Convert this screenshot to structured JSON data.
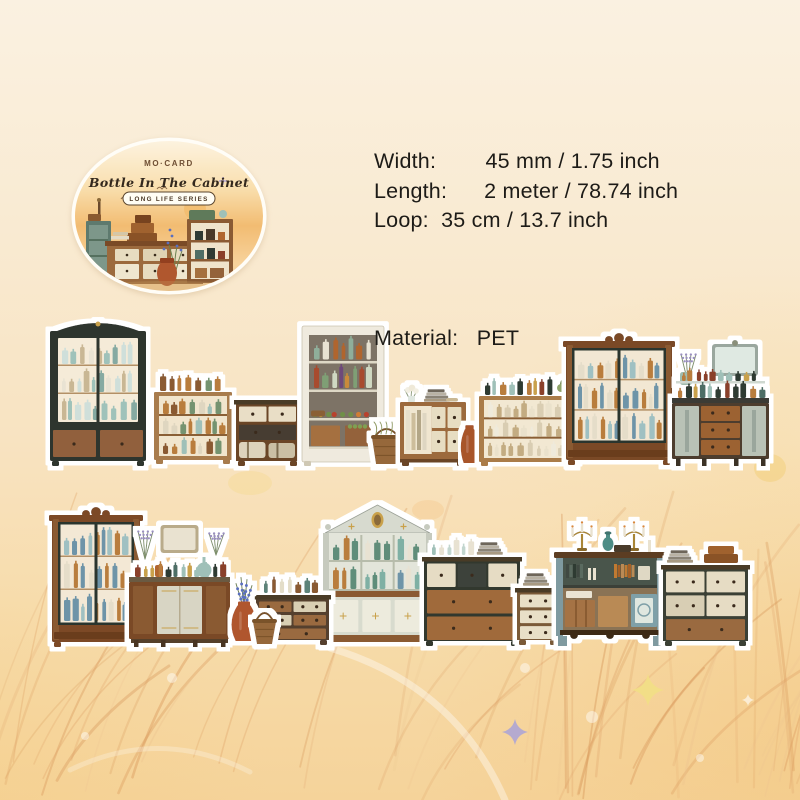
{
  "badge": {
    "brand": "MO·CARD",
    "title": "Bottle In The Cabinet",
    "series": "LONG LIFE SERIES"
  },
  "specs": {
    "width_label": "Width:",
    "width_value": "45 mm / 1.75 inch",
    "length_label": "Length:",
    "length_value": "2 meter / 78.74 inch",
    "loop_label": "Loop:",
    "loop_value": "35 cm / 13.7 inch",
    "material_label": "Material:",
    "material_value": "PET",
    "display_block": "Width:        45 mm / 1.75 inch\nLength:      2 meter / 78.74 inch\nLoop:  35 cm / 13.7 inch",
    "material_line": "Material:   PET"
  },
  "colors": {
    "background_top": "#faf1e1",
    "background_bottom": "#f5d39a",
    "text": "#1d1b17",
    "halo": "#ffffff",
    "dark_cabinet": "#2e342f",
    "wood": "#9c6a3d",
    "walnut": "#7a4a28",
    "cream_drawer": "#e6dcc4",
    "terracotta": "#b0572e",
    "teal": "#7f9aa0",
    "badge_sky": "#f2bc72"
  },
  "palettes": {
    "glass": [
      "#c2d6cf",
      "#9fc0b8",
      "#e8e2d2"
    ],
    "jars": [
      "#5d8379",
      "#b6cdc6",
      "#8a5a33",
      "#e3ddc8"
    ],
    "liqueur": [
      "#b97d3c",
      "#4e6e66",
      "#2f3a33",
      "#9fc0b8",
      "#8a3f2a",
      "#c9a14c"
    ],
    "cabinetBottles": [
      "#cfdfda",
      "#9fc2ba",
      "#e9e3d3",
      "#86aaa2",
      "#c9b794"
    ],
    "amberGreen": [
      "#b97d3c",
      "#74936f",
      "#9fc0b8",
      "#8a5a33",
      "#dfd6c0"
    ],
    "whites": [
      "#eae1cb",
      "#d9cdb2",
      "#c3ac82",
      "#efeadb"
    ],
    "armoireBottles": [
      "#9fc0c2",
      "#b97d3c",
      "#e5ddc9",
      "#6e94a8"
    ],
    "pantryJars": [
      "#d9cfb8",
      "#e8e2d2",
      "#b0652f",
      "#8fae9a"
    ],
    "pantryColor": [
      "#a84b2f",
      "#7f9f74",
      "#c98a3b",
      "#cfd8c2",
      "#6e4a7a"
    ],
    "produce": [
      "#b8432f",
      "#cf7e35",
      "#6f8f4a",
      "#d9b13e"
    ],
    "hutchBottles": [
      "#5f8d7a",
      "#7fb0a4",
      "#b97d3c",
      "#e8e2d2",
      "#6e94a8"
    ]
  },
  "scene": {
    "strip1": {
      "items": [
        {
          "name": "dark-display-cabinet",
          "kind": "glass-cabinet",
          "x": 50,
          "y": 319,
          "w": 96,
          "h": 147,
          "frame": "#2e342f",
          "interior": "#f5ebd8",
          "rows": 3,
          "pal": "cabinetBottles",
          "pediment": "arch",
          "base": "drawers",
          "baseColors": [
            "#91613c",
            "#91613c"
          ],
          "seed": 11
        },
        {
          "name": "bottle-shelf-unit",
          "kind": "open-shelf",
          "x": 154,
          "y": 374,
          "w": 78,
          "h": 90,
          "frame": "#a87c4e",
          "interior": "#f1e5cd",
          "rows": 3,
          "pal": "amberGreen",
          "seed": 23
        },
        {
          "name": "suitcase-chest",
          "kind": "chest",
          "x": 236,
          "y": 400,
          "w": 63,
          "h": 66,
          "frame": "#6b4527",
          "rowsSpec": [
            [
              "#e9dec6",
              "#e9dec6"
            ],
            [
              "#473d33"
            ]
          ],
          "bottom": "suitcases",
          "seed": 5
        },
        {
          "name": "pantry-shelf",
          "kind": "pantry",
          "x": 302,
          "y": 326,
          "w": 82,
          "h": 140
        },
        {
          "name": "harvest-basket",
          "kind": "basket",
          "x": 371,
          "y": 430,
          "w": 31,
          "h": 34,
          "greens": true
        },
        {
          "name": "book-cabinet",
          "kind": "small-cabinet",
          "x": 400,
          "y": 386,
          "w": 66,
          "h": 80
        },
        {
          "name": "clay-jug",
          "kind": "vase",
          "x": 459,
          "y": 419,
          "w": 21,
          "h": 46,
          "color": "#a8542c",
          "flowers": false
        },
        {
          "name": "jar-linen-shelf",
          "kind": "open-shelf",
          "x": 479,
          "y": 378,
          "w": 99,
          "h": 88,
          "frame": "#aa7c4a",
          "interior": "#f2e8d2",
          "rows": 3,
          "pal": "whites",
          "topPal": "liqueur",
          "plant": true,
          "seed": 31
        },
        {
          "name": "walnut-armoire",
          "kind": "glass-cabinet",
          "x": 566,
          "y": 333,
          "w": 106,
          "h": 132,
          "frame": "#7a4a28",
          "doors": "#2b342e",
          "columns": true,
          "interior": "#f2e7d3",
          "rows": 3,
          "pal": "armoireBottles",
          "pediment": "crown",
          "base": "plinth",
          "seed": 41
        },
        {
          "name": "mirror-bottle-dresser",
          "kind": "mirror-dresser",
          "x": 672,
          "y": 344,
          "w": 97,
          "h": 122,
          "variant": 1,
          "seed": 71
        }
      ]
    },
    "strip2": {
      "items": [
        {
          "name": "dark-armoire",
          "kind": "glass-cabinet",
          "x": 52,
          "y": 507,
          "w": 88,
          "h": 140,
          "frame": "#7c4a28",
          "doors": "#2c352f",
          "columns": true,
          "interior": "#f3e8d5",
          "rows": 3,
          "pal": "armoireBottles",
          "pediment": "crown",
          "base": "plinth",
          "seed": 7
        },
        {
          "name": "vanity-dresser",
          "kind": "mirror-dresser",
          "x": 129,
          "y": 523,
          "w": 101,
          "h": 124,
          "variant": 2,
          "seed": 79
        },
        {
          "name": "pediment-hutch",
          "kind": "hutch",
          "x": 321,
          "y": 503,
          "w": 113,
          "h": 143
        },
        {
          "name": "jar-chest",
          "kind": "chest",
          "x": 256,
          "y": 577,
          "w": 73,
          "h": 68,
          "frame": "#54412f",
          "rowsSpec": [
            [
              "#9a6a3f",
              "#d9cfb4"
            ],
            [
              "#d9cfb4",
              "#9a6a3f"
            ],
            [
              "#9a6a3f"
            ]
          ],
          "top": "jars",
          "seed": 13
        },
        {
          "name": "terracotta-flower-vase",
          "kind": "vase",
          "x": 229,
          "y": 565,
          "w": 30,
          "h": 78,
          "color": "#b0572e",
          "flowers": true,
          "flowerColor": "#5a6fc0"
        },
        {
          "name": "wicker-basket",
          "kind": "basket",
          "x": 252,
          "y": 614,
          "w": 25,
          "h": 30,
          "greens": false
        },
        {
          "name": "linen-chest",
          "kind": "chest",
          "x": 424,
          "y": 539,
          "w": 96,
          "h": 107,
          "frame": "#32382f",
          "rowsSpec": [
            [
              "#e6dcc4",
              "#3c433a",
              "#e6dcc4"
            ],
            [
              "#a06a3a"
            ],
            [
              "#a06a3a"
            ]
          ],
          "top": "bottles",
          "seed": 17
        },
        {
          "name": "book-drawer-unit",
          "kind": "chest",
          "x": 517,
          "y": 570,
          "w": 42,
          "h": 75,
          "frame": "#7a5a38",
          "rowsSpec": [
            [
              "#e8dfc7"
            ],
            [
              "#e8dfc7"
            ],
            [
              "#e8dfc7"
            ]
          ],
          "top": "books",
          "seed": 19
        },
        {
          "name": "candelabra-sideboard",
          "kind": "sideboard",
          "x": 556,
          "y": 518,
          "w": 108,
          "h": 128
        },
        {
          "name": "box-chest",
          "kind": "chest",
          "x": 663,
          "y": 547,
          "w": 85,
          "h": 99,
          "frame": "#3a3f36",
          "rowsSpec": [
            [
              "#e6dcc4",
              "#e6dcc4"
            ],
            [
              "#d8ceb4",
              "#e6dcc4"
            ],
            [
              "#9a6a3f"
            ]
          ],
          "top": "boxes",
          "seed": 29
        }
      ]
    }
  },
  "decor": {
    "sparkles": [
      {
        "x": 515,
        "y": 732,
        "r": 13,
        "color": "#a9a2d8",
        "opacity": 0.85
      },
      {
        "x": 648,
        "y": 690,
        "r": 16,
        "color": "#f2df85",
        "opacity": 0.9
      },
      {
        "x": 748,
        "y": 700,
        "r": 6,
        "color": "#ffffff",
        "opacity": 0.6
      }
    ],
    "dots": [
      {
        "x": 525,
        "y": 668,
        "r": 5
      },
      {
        "x": 592,
        "y": 717,
        "r": 6
      },
      {
        "x": 172,
        "y": 678,
        "r": 5
      },
      {
        "x": 85,
        "y": 736,
        "r": 4
      },
      {
        "x": 700,
        "y": 758,
        "r": 4
      }
    ],
    "blobs": [
      {
        "x": 770,
        "y": 468,
        "rx": 16,
        "ry": 14,
        "color": "#f2cf7e",
        "opacity": 0.55
      },
      {
        "x": 250,
        "y": 483,
        "rx": 22,
        "ry": 12,
        "color": "#f4d98e",
        "opacity": 0.4
      },
      {
        "x": 428,
        "y": 510,
        "rx": 16,
        "ry": 10,
        "color": "#f6c98c",
        "opacity": 0.4
      }
    ],
    "wheat_colors": [
      "#e2a96f",
      "#ecc390",
      "#d9985c"
    ]
  }
}
